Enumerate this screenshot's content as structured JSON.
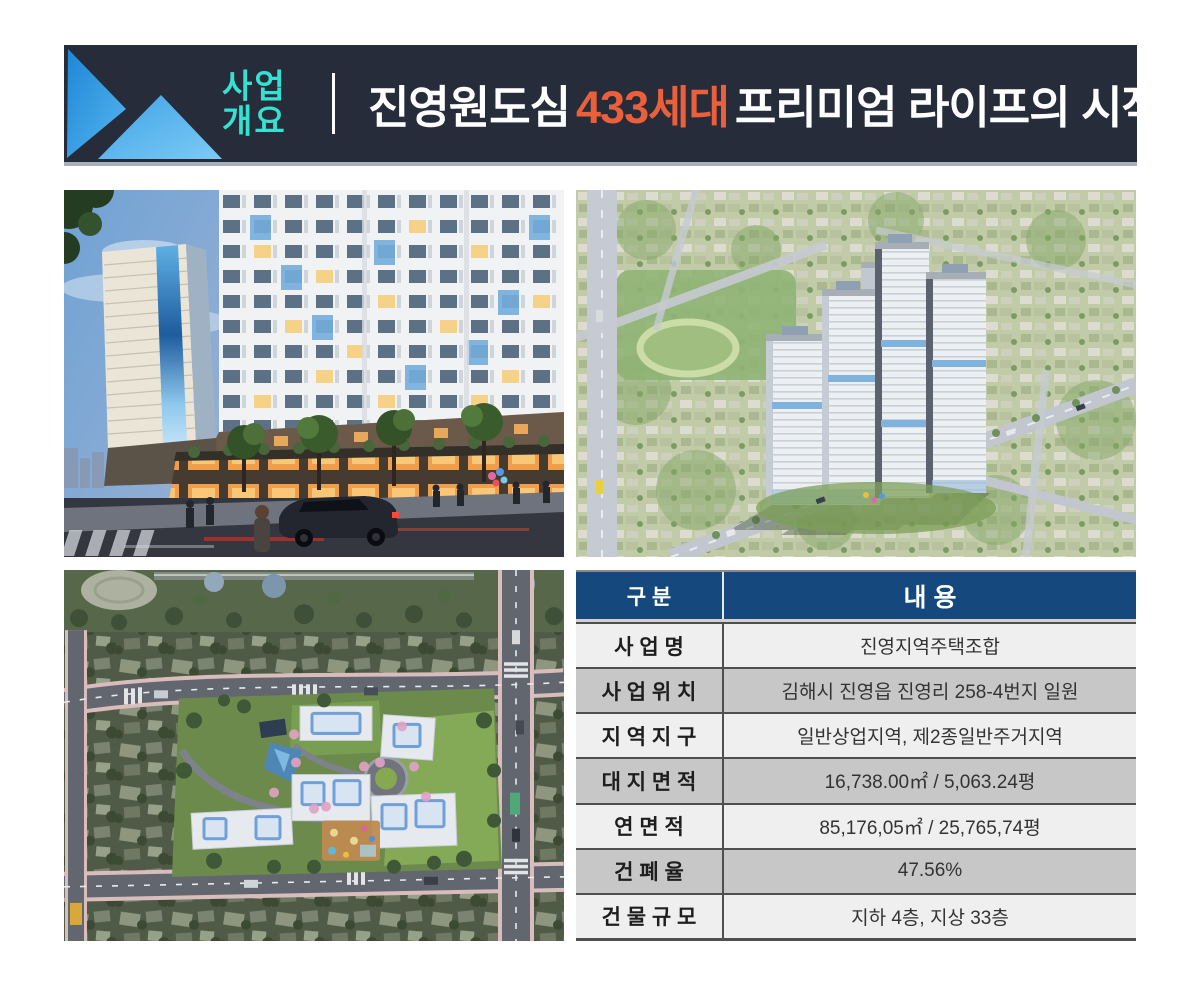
{
  "header": {
    "badge": {
      "line1": "사업",
      "line2": "개요"
    },
    "title": {
      "pre": "진영원도심",
      "highlight": "433세대",
      "post": "프리미엄 라이프의 시작!"
    }
  },
  "table": {
    "columns": {
      "label": "구  분",
      "value": "내  용"
    },
    "rows": [
      {
        "label": "사  업  명",
        "value": "진영지역주택조합"
      },
      {
        "label": "사 업 위 치",
        "value": "김해시 진영읍 진영리 258-4번지 일원"
      },
      {
        "label": "지 역 지 구",
        "value": "일반상업지역, 제2종일반주거지역"
      },
      {
        "label": "대 지 면 적",
        "value": "16,738.00㎡ / 5,063.24평"
      },
      {
        "label": "연  면  적",
        "value": "85,176,05㎡ / 25,765,74평"
      },
      {
        "label": "건  폐  율",
        "value": "47.56%"
      },
      {
        "label": "건 물 규 모",
        "value": "지하 4층, 지상 33층"
      }
    ]
  },
  "colors": {
    "banner_bg": "#262c39",
    "badge_text": "#35e2d2",
    "title_text": "#ffffff",
    "title_highlight": "#eb5f3a",
    "logo_blue_dark": "#1f86d6",
    "logo_blue_light": "#63c0f2",
    "table_header_bg": "#15497e",
    "table_row_light": "#efefef",
    "table_row_shaded": "#c7c7c7"
  }
}
